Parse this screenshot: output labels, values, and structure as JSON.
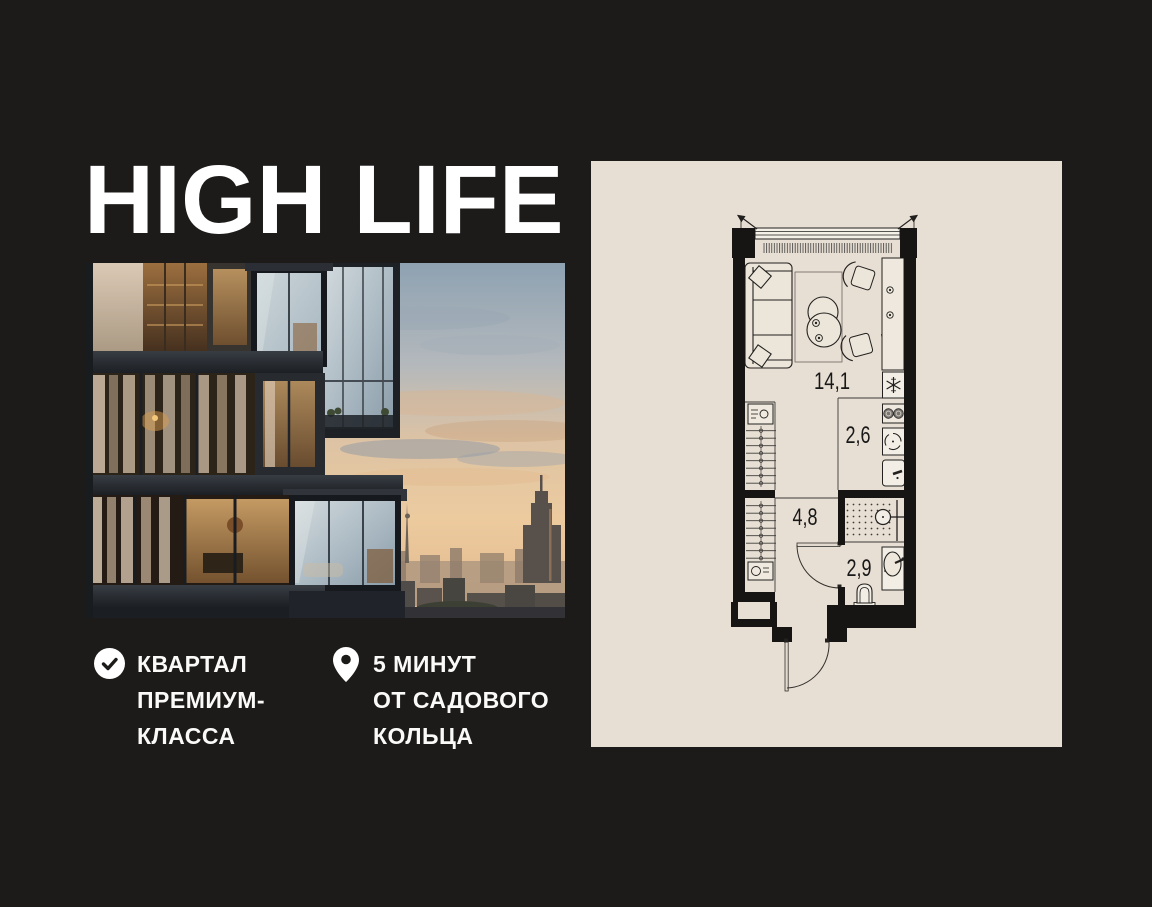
{
  "page": {
    "background_color": "#1d1b19",
    "panel_color": "#e8dfd4"
  },
  "logo": {
    "text": "HIGH LIFE"
  },
  "features": [
    {
      "icon": "check-circle-icon",
      "lines": [
        "КВАРТАЛ",
        "ПРЕМИУМ-",
        "КЛАССА"
      ]
    },
    {
      "icon": "location-pin-icon",
      "lines": [
        "5 МИНУТ",
        "ОТ САДОВОГО",
        "КОЛЬЦА"
      ]
    }
  ],
  "floor_plan": {
    "rooms": [
      {
        "name": "living-room",
        "area": "14,1"
      },
      {
        "name": "kitchen",
        "area": "2,6"
      },
      {
        "name": "hallway",
        "area": "4,8"
      },
      {
        "name": "bathroom",
        "area": "2,9"
      }
    ]
  }
}
